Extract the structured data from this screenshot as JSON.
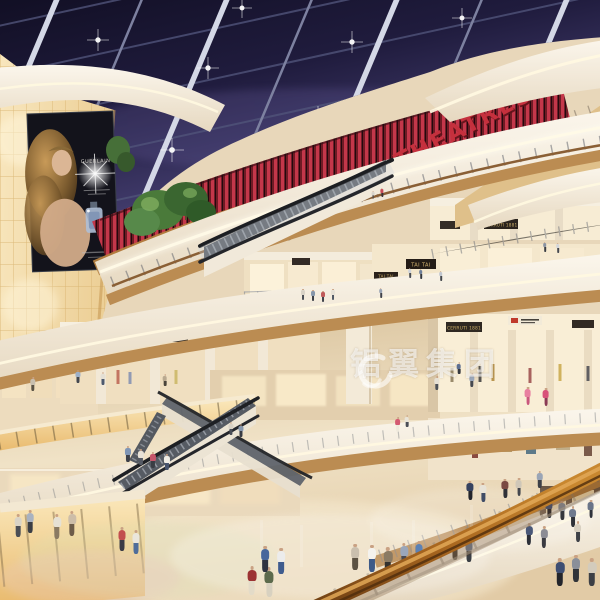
{
  "signs": {
    "theatres": "THEATRES",
    "cerruti_1881": "CERRUTI 1881",
    "tai_tai": "TAI TAI",
    "billboard_brand": "GUERLAIN"
  },
  "watermark": {
    "text": "铝翼集团",
    "color": "#ffffff"
  },
  "colors": {
    "skylight_dark": "#0f0d20",
    "skylight_light": "#5a5490",
    "roof_beam": "#d4d8e6",
    "theatre_red": "#c5303d",
    "fascia_cream": "#faf5ea",
    "wood_band": "#bb8c52",
    "glow_wall": "#f8e6bd",
    "floor": "#ecdcbe",
    "foreground_handrail": "#a9671f",
    "led_screen_fire": "#ff9d35"
  },
  "people": [
    [
      57,
      540,
      26,
      "#e6e1d4",
      "#8a7a62"
    ],
    [
      72,
      537,
      26,
      "#cdbda8",
      "#6d5c49"
    ],
    [
      122,
      552,
      25,
      "#c24e4e",
      "#3c3c46"
    ],
    [
      136,
      555,
      25,
      "#eae6dc",
      "#4f6d9a"
    ],
    [
      252,
      596,
      30,
      "#9c3333",
      "#e3dbc8"
    ],
    [
      269,
      598,
      31,
      "#5c6a4c",
      "#d8d1c0"
    ],
    [
      265,
      573,
      27,
      "#47679c",
      "#2f3340"
    ],
    [
      281,
      575,
      27,
      "#ececec",
      "#3f5c8e"
    ],
    [
      355,
      571,
      27,
      "#cabfae",
      "#5c5243"
    ],
    [
      372,
      573,
      28,
      "#f4f2ee",
      "#3e5a88"
    ],
    [
      388,
      576,
      29,
      "#8a7a63",
      "#32312f"
    ],
    [
      404,
      569,
      26,
      "#9aa6ba",
      "#4a4a52"
    ],
    [
      419,
      566,
      25,
      "#5b81b5",
      "#33363e"
    ],
    [
      455,
      561,
      25,
      "#d9d2c4",
      "#5a5248"
    ],
    [
      469,
      563,
      25,
      "#7a8699",
      "#3a3e45"
    ],
    [
      529,
      546,
      23,
      "#4a5878",
      "#2c2f38"
    ],
    [
      544,
      549,
      23,
      "#8c8c94",
      "#3a3a40"
    ],
    [
      560,
      587,
      29,
      "#3e4e72",
      "#23252b"
    ],
    [
      576,
      583,
      28,
      "#8a8f99",
      "#303338"
    ],
    [
      592,
      587,
      29,
      "#d3cbbc",
      "#3c3f45"
    ],
    [
      573,
      528,
      22,
      "#6f7a8e",
      "#2e3138"
    ],
    [
      18,
      538,
      24,
      "#d9d3c6",
      "#4b4e55"
    ],
    [
      30,
      534,
      24,
      "#a9b2c0",
      "#3b3e45"
    ],
    [
      33,
      392,
      15,
      "#c8bfae",
      "#5a5345"
    ],
    [
      78,
      384,
      14,
      "#9db0c8",
      "#43474f"
    ],
    [
      103,
      386,
      14,
      "#e4dfd4",
      "#4e5a6e"
    ],
    [
      165,
      387,
      13,
      "#b9a98f",
      "#4a443a"
    ],
    [
      128,
      463,
      17,
      "#7f95b5",
      "#3c3f48"
    ],
    [
      141,
      466,
      17,
      "#e8e2d6",
      "#555a64"
    ],
    [
      153,
      469,
      17,
      "#c7556a",
      "#3a3d44"
    ],
    [
      167,
      471,
      17,
      "#efece4",
      "#47546e"
    ],
    [
      231,
      436,
      14,
      "#d8d2c6",
      "#4a4e57"
    ],
    [
      241,
      438,
      14,
      "#8898ad",
      "#393c43"
    ],
    [
      398,
      433,
      16,
      "#d45a72",
      "#efe9dc"
    ],
    [
      407,
      428,
      13,
      "#e9e4d8",
      "#4c4f57"
    ],
    [
      528,
      406,
      19,
      "#e87fa0",
      "#c9577d"
    ],
    [
      546,
      407,
      19,
      "#d8527a",
      "#8a3a55"
    ],
    [
      472,
      388,
      15,
      "#9aa7bb",
      "#45484f"
    ],
    [
      459,
      375,
      13,
      "#5d6f92",
      "#35383f"
    ],
    [
      437,
      391,
      15,
      "#e6e0d4",
      "#4d5158"
    ],
    [
      470,
      501,
      20,
      "#36425f",
      "#23252c"
    ],
    [
      483,
      503,
      20,
      "#e8e3d7",
      "#3f4c66"
    ],
    [
      505,
      499,
      20,
      "#7a4a43",
      "#2f3138"
    ],
    [
      519,
      497,
      19,
      "#cfc7b8",
      "#44474e"
    ],
    [
      540,
      489,
      18,
      "#9aa5b6",
      "#3c3f46"
    ],
    [
      549,
      519,
      20,
      "#49597c",
      "#2b2d34"
    ],
    [
      562,
      521,
      20,
      "#8b93a1",
      "#35373d"
    ],
    [
      578,
      543,
      22,
      "#d8d0c1",
      "#3e4147"
    ],
    [
      591,
      519,
      19,
      "#6a7488",
      "#30323a"
    ],
    [
      303,
      300,
      11,
      "#d9d3c7",
      "#4a4e55"
    ],
    [
      313,
      301,
      11,
      "#8797ab",
      "#3a3d44"
    ],
    [
      323,
      302,
      11,
      "#c05a5a",
      "#3e4149"
    ],
    [
      333,
      300,
      11,
      "#e6e1d6",
      "#4f5864"
    ],
    [
      381,
      298,
      10,
      "#9aa4b4",
      "#41444b"
    ],
    [
      410,
      278,
      10,
      "#cfd3da",
      "#494c52"
    ],
    [
      421,
      279,
      10,
      "#6f7f9a",
      "#35383f"
    ],
    [
      441,
      281,
      10,
      "#c0c6cf",
      "#44474d"
    ],
    [
      545,
      252,
      10,
      "#8a93a2",
      "#3a3d43"
    ],
    [
      558,
      253,
      10,
      "#d3d6db",
      "#464950"
    ],
    [
      382,
      197,
      9,
      "#c84a55",
      "#3a3034"
    ],
    [
      373,
      199,
      8,
      "#d8d4cb",
      "#44464c"
    ]
  ]
}
